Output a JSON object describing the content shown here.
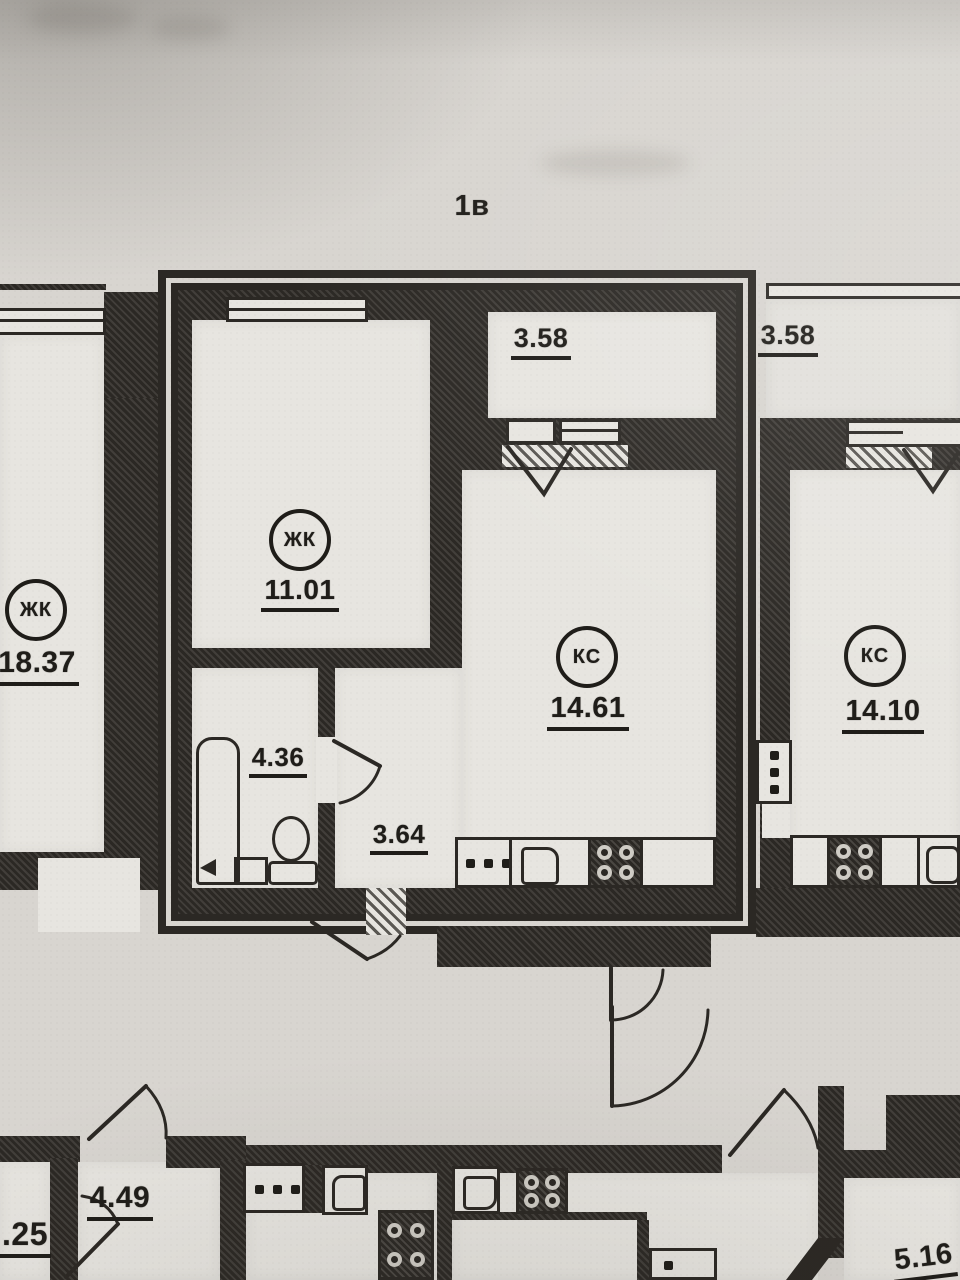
{
  "plan": {
    "title": "1в",
    "main": {
      "living": {
        "tag": "ЖК",
        "area": "11.01"
      },
      "kitchen": {
        "tag": "КС",
        "area": "14.61"
      },
      "balcony_area": "3.58",
      "bathroom_area": "4.36",
      "hallway_area": "3.64"
    },
    "left": {
      "living": {
        "tag": "ЖК",
        "area": "18.37"
      }
    },
    "right": {
      "kitchen": {
        "tag": "КС",
        "area": "14.10"
      },
      "balcony_area": "3.58"
    },
    "bottom": {
      "room_a_area": "4.49",
      "room_b_area": ".25",
      "room_c_area": "5.16"
    }
  },
  "legend": {
    "fixtures": [
      "bathtub",
      "toilet",
      "wash-basin",
      "kitchen-sink",
      "stove",
      "vent-panel",
      "window",
      "door-swing"
    ]
  },
  "colors": {
    "paper": "#d8d5d0",
    "ink": "#2b2824",
    "room": "#e7e5e0"
  }
}
